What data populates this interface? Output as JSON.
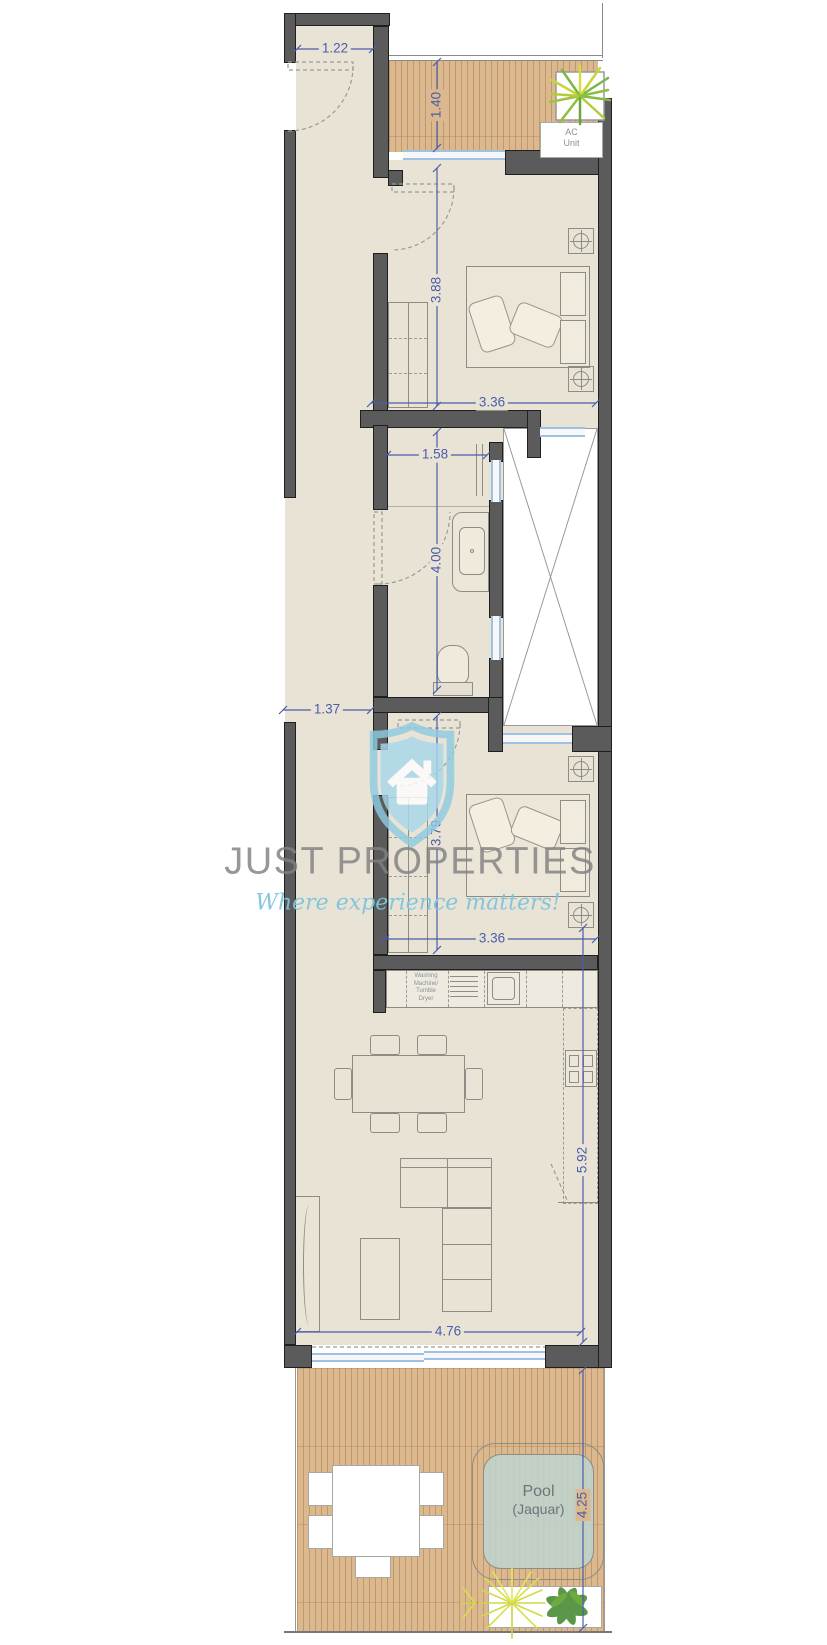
{
  "watermark": {
    "brand": "JUST PROPERTIES",
    "tagline": "Where experience matters!"
  },
  "labels": {
    "ac_line1": "AC",
    "ac_line2": "Unit",
    "pool_line1": "Pool",
    "pool_line2": "(Jaquar)",
    "washer_line1": "Washing",
    "washer_line2": "Machine/",
    "washer_line3": "Tumble",
    "washer_line4": "Dryer"
  },
  "dims": {
    "entry_width": "1.22",
    "balcony_depth": "1.40",
    "bedroom1_length": "3.88",
    "bedroom1_width": "3.36",
    "bath_width": "1.58",
    "bath_length": "4.00",
    "hall_width": "1.37",
    "bedroom2_length": "3.79",
    "bedroom2_width": "3.36",
    "living_length": "5.92",
    "living_width": "4.76",
    "terrace_length": "4.25"
  },
  "colors": {
    "wall": "#5b5b5b",
    "floor": "#e9e3d6",
    "deck": "#dcb88f",
    "pool": "#c9d8d3",
    "dimension": "#4a5da8",
    "window": "#9fc2e4",
    "watermark_gray": "#9b9b9b",
    "watermark_blue": "#8cc5dd"
  }
}
